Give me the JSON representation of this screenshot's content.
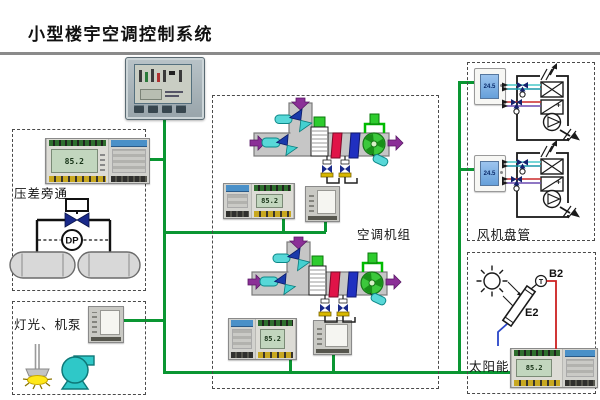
{
  "header": {
    "title": "小型楼宇空调控制系统"
  },
  "sections": {
    "pressure_bypass": {
      "label": "压差旁通",
      "dp_sensor_label": "DP"
    },
    "lighting_pumps": {
      "label": "灯光、机泵"
    },
    "ahu": {
      "label": "空调机组"
    },
    "fan_coil": {
      "label": "风机盘管",
      "thermostat_display": "24.5"
    },
    "solar": {
      "label": "太阳能",
      "sensor_label_b2": "B2",
      "collector_label_e2": "E2",
      "temp_sensor_label": "T"
    }
  },
  "devices": {
    "ddc_lcd_display": "85.2"
  },
  "colors": {
    "bus_green": "#0a9632",
    "duct_gray": "#c6c6c6",
    "coil_red": "#e01448",
    "coil_blue": "#2030c0",
    "fan_green": "#3cc83c",
    "actuator_green": "#2ecc2e",
    "sensor_cyan": "#58d8d8",
    "pump_cyan": "#2fc8c8",
    "valve_navy": "#1a2a8a",
    "airflow_purple": "#8b2f97",
    "hot_pipe_red": "#cc2020",
    "cold_pipe_blue": "#2a46c8",
    "lamp_yellow": "#ffe818"
  }
}
